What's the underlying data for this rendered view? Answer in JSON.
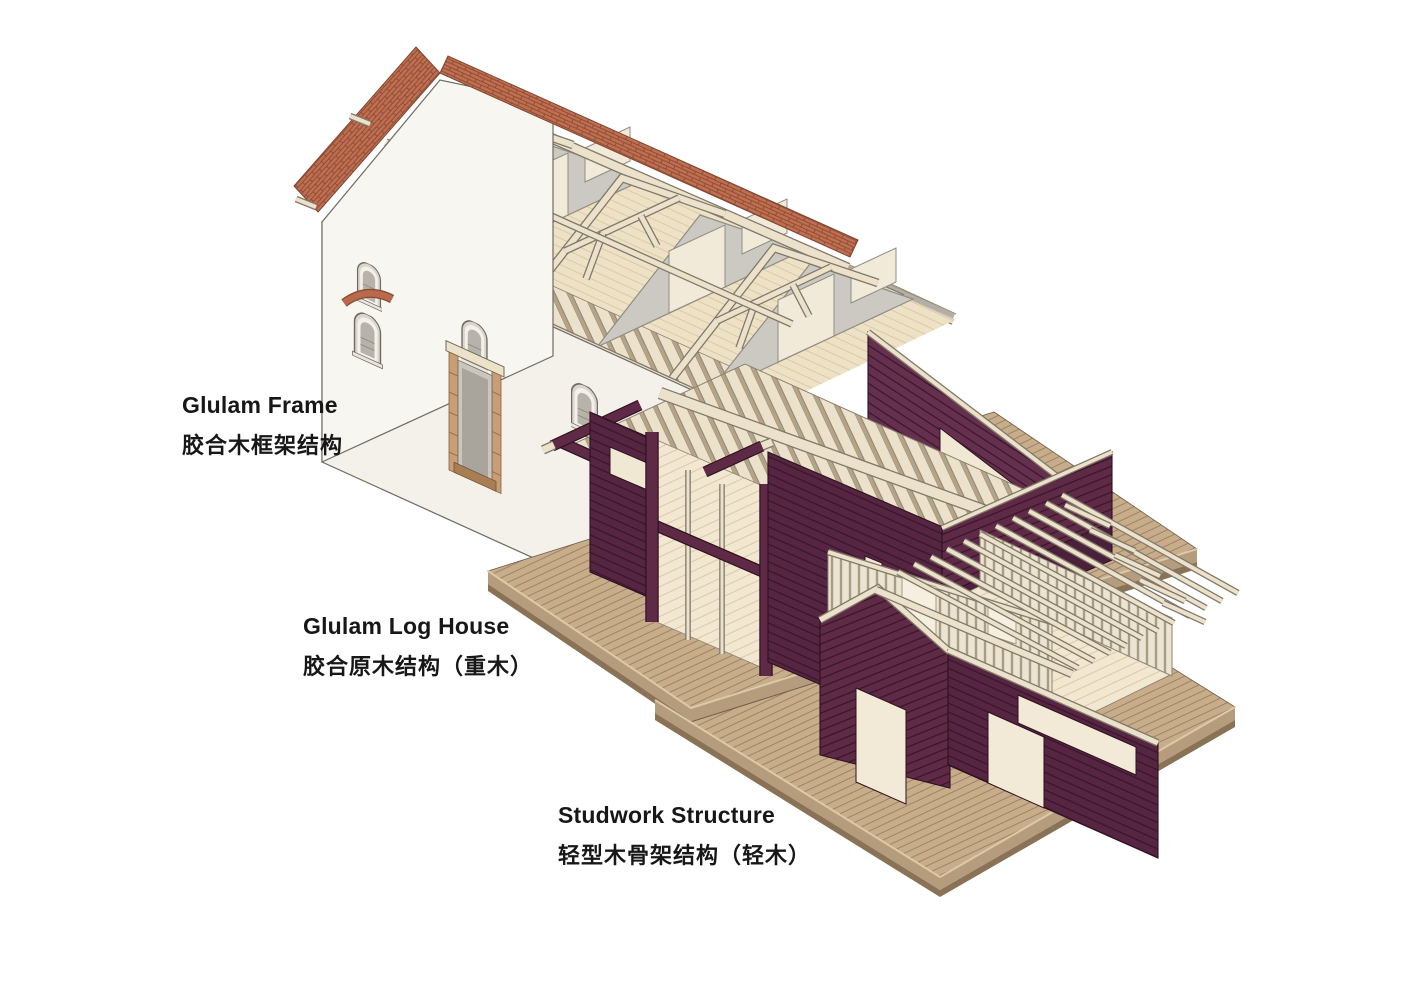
{
  "figure": {
    "kind": "architectural axonometric diagram",
    "subject": "three timber construction systems of one building complex"
  },
  "labels": [
    {
      "id": "glulam-frame",
      "en": "Glulam Frame",
      "zh": "胶合木框架结构"
    },
    {
      "id": "glulam-log-house",
      "en": "Glulam Log House",
      "zh": "胶合原木结构（重木）"
    },
    {
      "id": "studwork-structure",
      "en": "Studwork Structure",
      "zh": "轻型木骨架结构（轻木）"
    }
  ],
  "palette": {
    "label-color": "#171717",
    "white-wall": "#f3f1ea",
    "white-gable": "#f8f6f0",
    "outline-dark": "#6f6b62",
    "timber": "#ece2cb",
    "timber-dark": "#80796a",
    "joist-gap": "#b4a387",
    "maroon": "#552541",
    "maroon-mid": "#5e2a46",
    "maroon-light": "#65304e",
    "maroon-line": "#38152b",
    "maroon-outline": "#2e1120",
    "brick": "#c06f50",
    "brick-dark": "#8f4c36",
    "tan": "#cdb496",
    "tan-line": "#bda180",
    "gray-partition": "#cbc9c2",
    "deck": "#c8ad8b",
    "deck-line": "#9d8366",
    "deck-side": "#b59c7c",
    "deck-side-dark": "#8a7257",
    "floor": "#f2e7d1",
    "floor-line": "#dcc9a6",
    "attic-floor": "#eee2c6",
    "stud-bg": "#ece4d2",
    "stud-line": "#a89c82"
  }
}
